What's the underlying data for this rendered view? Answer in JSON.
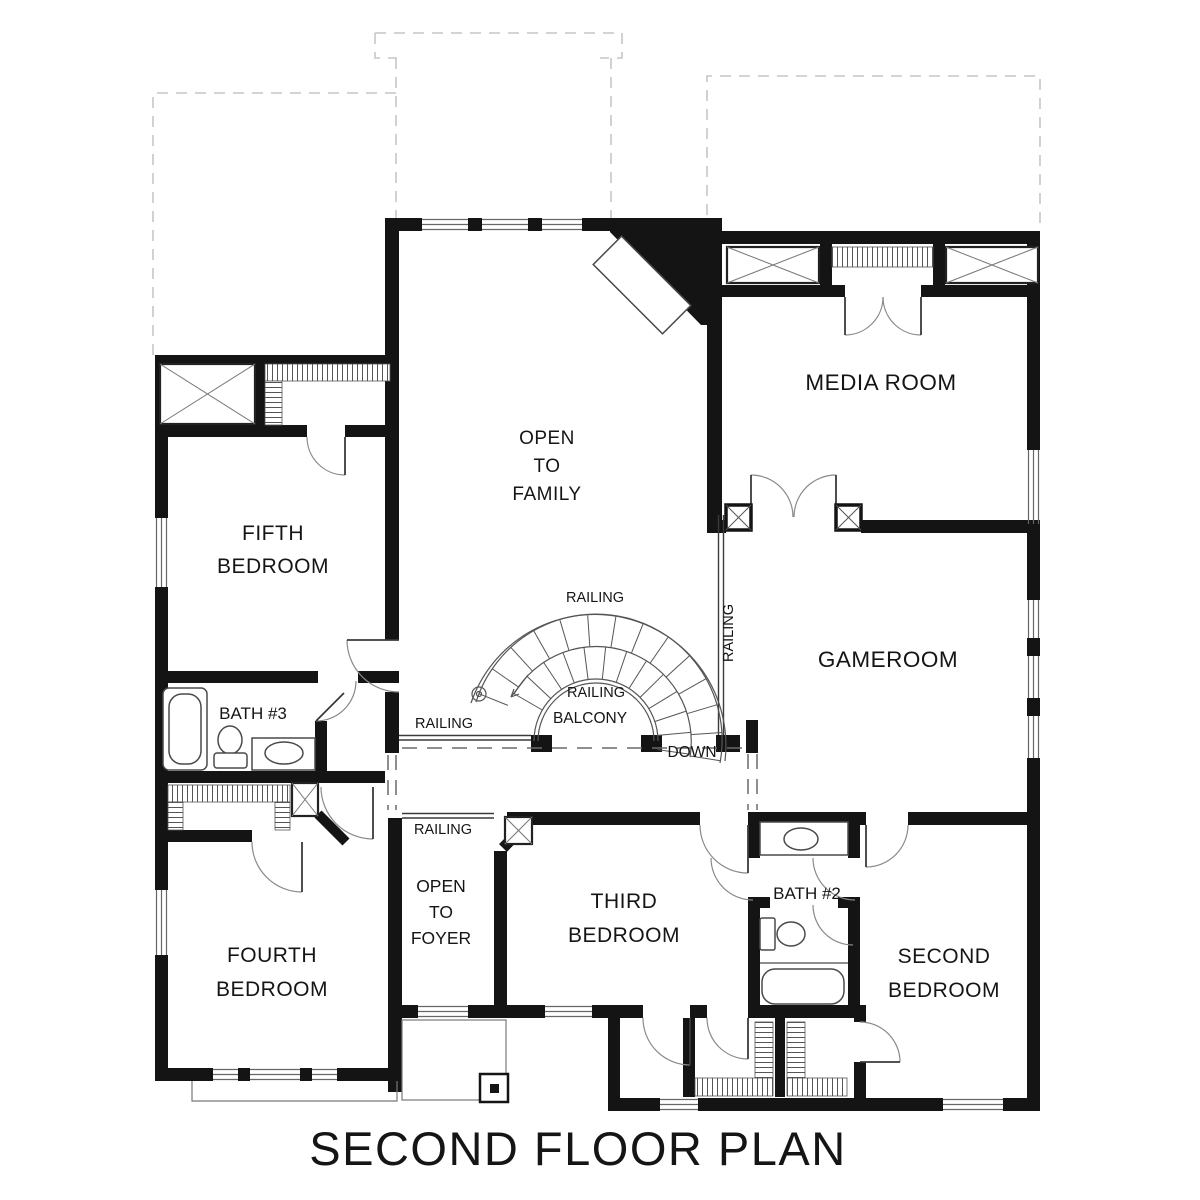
{
  "title": "SECOND FLOOR PLAN",
  "rooms": {
    "fifth_bedroom": {
      "lines": [
        "FIFTH",
        "BEDROOM"
      ]
    },
    "open_to_family": {
      "lines": [
        "OPEN",
        "TO",
        "FAMILY"
      ]
    },
    "media_room": {
      "label": "MEDIA ROOM"
    },
    "gameroom": {
      "label": "GAMEROOM"
    },
    "bath_3": {
      "label": "BATH #3"
    },
    "fourth_bedroom": {
      "lines": [
        "FOURTH",
        "BEDROOM"
      ]
    },
    "open_to_foyer": {
      "lines": [
        "OPEN",
        "TO",
        "FOYER"
      ]
    },
    "third_bedroom": {
      "lines": [
        "THIRD",
        "BEDROOM"
      ]
    },
    "bath_2": {
      "label": "BATH #2"
    },
    "second_bedroom": {
      "lines": [
        "SECOND",
        "BEDROOM"
      ]
    }
  },
  "annotations": {
    "railing": "RAILING",
    "balcony": "BALCONY",
    "down": "DOWN"
  },
  "colors": {
    "wall": "#141414",
    "thin_line": "#4a4a4a",
    "roof_dash": "#c6c6c6",
    "background": "#ffffff"
  }
}
